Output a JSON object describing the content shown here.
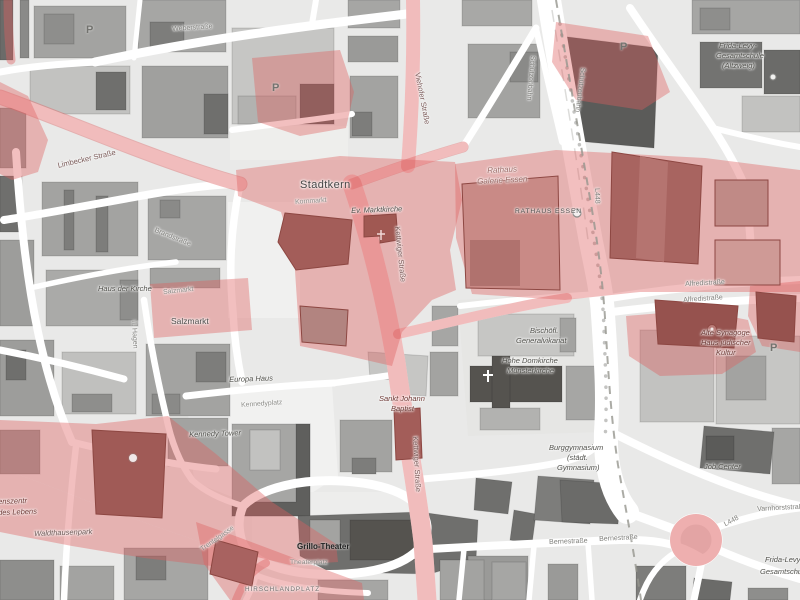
{
  "map": {
    "description": "Grayscale city-centre map of Essen with red highlighted zones",
    "colors": {
      "background": "#e9e9e8",
      "street": "#ffffff",
      "building_gray": "#a6a6a4",
      "building_dark": "#5f5f5d",
      "highlight_zone": "#de6060",
      "highlight_building": "#a35d59"
    }
  },
  "icons": {
    "parking_glyph": "P"
  },
  "labels": [
    {
      "id": "stadtkern",
      "text": "Stadtkern"
    },
    {
      "id": "kornmarkt",
      "text": "Kornmarkt"
    },
    {
      "id": "marktkirche",
      "text": "Ev. Marktkirche"
    },
    {
      "id": "kettwiger-1",
      "text": "Kettwiger Straße"
    },
    {
      "id": "kettwiger-2",
      "text": "Kettwiger Straße"
    },
    {
      "id": "rathaus-galerie-1",
      "text": "Rathaus"
    },
    {
      "id": "rathaus-galerie-2",
      "text": "Galerie Essen"
    },
    {
      "id": "rathaus-essen",
      "text": "RATHAUS ESSEN"
    },
    {
      "id": "alfredistrasse-1",
      "text": "Alfredistraße"
    },
    {
      "id": "alfredistrasse-2",
      "text": "Alfredistraße"
    },
    {
      "id": "synagoge-1",
      "text": "Alte Synagoge"
    },
    {
      "id": "synagoge-2",
      "text": "Haus jüdischer"
    },
    {
      "id": "synagoge-3",
      "text": "Kultur"
    },
    {
      "id": "generalvikariat-1",
      "text": "Bischöfl."
    },
    {
      "id": "generalvikariat-2",
      "text": "Generalvikariat"
    },
    {
      "id": "muensterkirche-1",
      "text": "Hohe Domkirche"
    },
    {
      "id": "muensterkirche-2",
      "text": "Münsterkirche"
    },
    {
      "id": "burggymnasium-1",
      "text": "Burggymnasium"
    },
    {
      "id": "burggymnasium-2",
      "text": "(städt."
    },
    {
      "id": "burggymnasium-3",
      "text": "Gymnasium)"
    },
    {
      "id": "frida-levy-1",
      "text": "Frida-Levy-"
    },
    {
      "id": "frida-levy-2",
      "text": "Gesamtschule"
    },
    {
      "id": "frida-levy-3",
      "text": "(Altzweig)"
    },
    {
      "id": "frida-levy-4",
      "text": "Frida-Levy"
    },
    {
      "id": "frida-levy-5",
      "text": "Gesamtschule"
    },
    {
      "id": "job-center",
      "text": "Job Center"
    },
    {
      "id": "waldthausenpark",
      "text": "Waldthausenpark"
    },
    {
      "id": "clipped-poi-1",
      "text": "enszentr"
    },
    {
      "id": "clipped-poi-2",
      "text": "des Lebens"
    },
    {
      "id": "salzmarkt-1",
      "text": "Salzmarkt"
    },
    {
      "id": "salzmarkt-2",
      "text": "Salzmarkt"
    },
    {
      "id": "europa-haus",
      "text": "Europa Haus"
    },
    {
      "id": "kennedyplatz",
      "text": "Kennedyplatz"
    },
    {
      "id": "kennedy-tower",
      "text": "Kennedy Tower"
    },
    {
      "id": "sankt-johann-1",
      "text": "Sankt Johann"
    },
    {
      "id": "sankt-johann-2",
      "text": "Baptist"
    },
    {
      "id": "grillo-theater",
      "text": "Grillo-Theater"
    },
    {
      "id": "theaterplatz",
      "text": "Theaterplatz"
    },
    {
      "id": "hirschlandplatz",
      "text": "HIRSCHLANDPLATZ"
    },
    {
      "id": "trentelgasse",
      "text": "Trentelgasse"
    },
    {
      "id": "limbecker-strasse",
      "text": "Limbecker Straße"
    },
    {
      "id": "viehofer-strasse",
      "text": "Viehofer Straße"
    },
    {
      "id": "weberstrasse",
      "text": "Weberstraße"
    },
    {
      "id": "schuetzenbahn-1",
      "text": "Schützenbahn"
    },
    {
      "id": "schuetzenbahn-2",
      "text": "Schützenbahn"
    },
    {
      "id": "haus-der-kirche",
      "text": "Haus der Kirche"
    },
    {
      "id": "brandstrasse",
      "text": "Brandstraße"
    },
    {
      "id": "bernestrasse-1",
      "text": "Bernestraße"
    },
    {
      "id": "bernestrasse-2",
      "text": "Bernestraße"
    },
    {
      "id": "varnhorststrasse",
      "text": "Varnhorststraße"
    },
    {
      "id": "l448-1",
      "text": "L448"
    },
    {
      "id": "l448-2",
      "text": "L448"
    },
    {
      "id": "ii-hagen",
      "text": "II. Hagen"
    }
  ]
}
